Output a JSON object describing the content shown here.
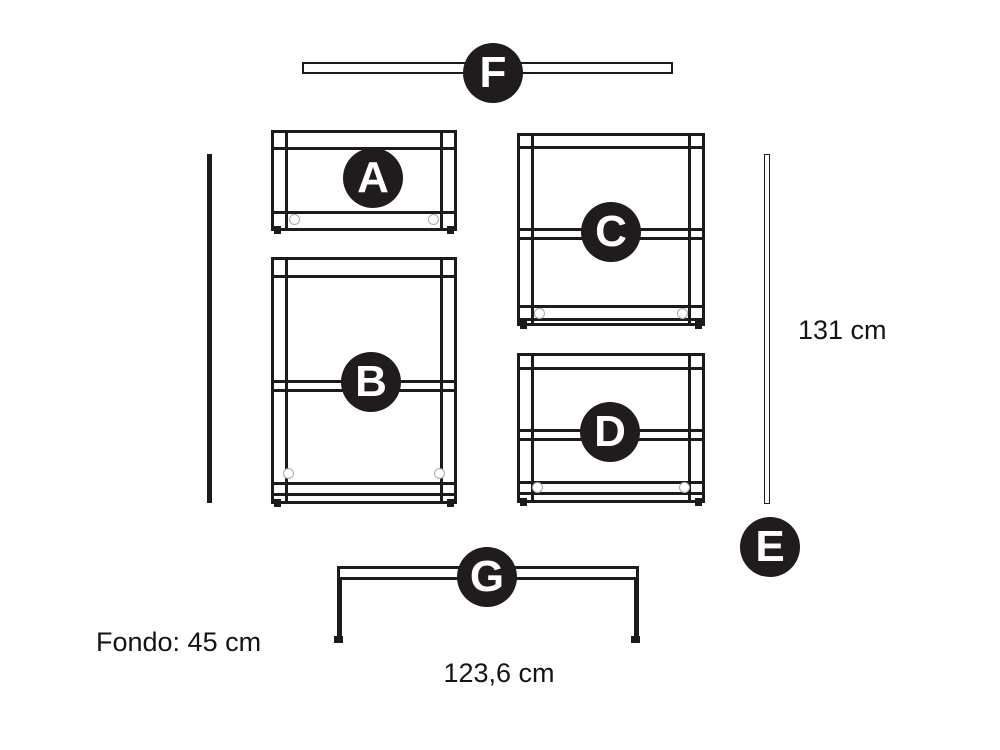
{
  "diagram": {
    "parts": [
      {
        "label": "A"
      },
      {
        "label": "B"
      },
      {
        "label": "C"
      },
      {
        "label": "D"
      },
      {
        "label": "E"
      },
      {
        "label": "F"
      },
      {
        "label": "G"
      }
    ],
    "dimensions": {
      "height_label": "131 cm",
      "width_label": "123,6 cm",
      "depth_label": "Fondo: 45 cm"
    },
    "colors": {
      "ink": "#1b1b1b",
      "badge_bg": "#201c1d",
      "badge_text": "#ffffff",
      "faint_gray": "#a9a9a9",
      "background": "#ffffff"
    }
  }
}
